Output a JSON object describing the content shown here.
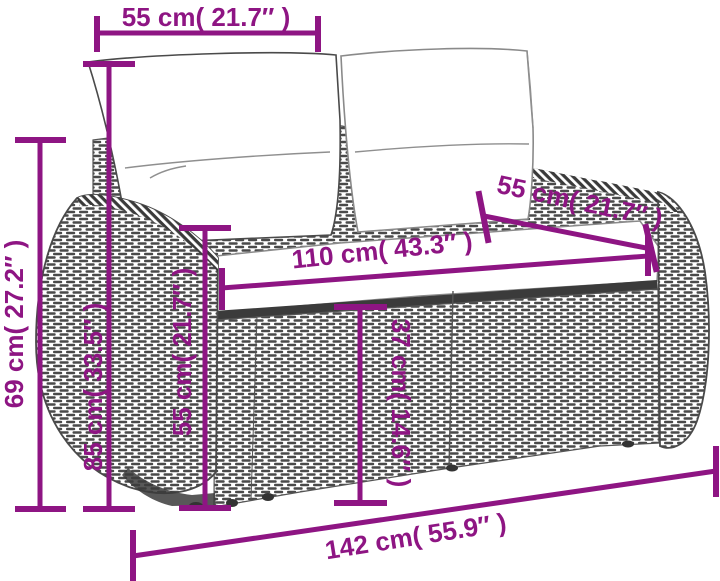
{
  "diagram": {
    "description": "Poly rattan 2-seater garden sofa with white cushions, annotated with product dimensions",
    "accent_color": "#8E1583",
    "line_art_color": "#4a4a4a",
    "labels": {
      "top_backrest_width": "55 cm( 21.7″ )",
      "left_total_height": "69 cm( 27.2″ )",
      "back_height": "85 cm( 33.5″ )",
      "armrest_height": "55 cm( 21.7″ )",
      "seat_width": "110 cm( 43.3″ )",
      "right_backrest_width": "55 cm( 21.7″ )",
      "seat_height": "37 cm( 14.6″ )",
      "total_width": "142 cm( 55.9″ )"
    }
  }
}
